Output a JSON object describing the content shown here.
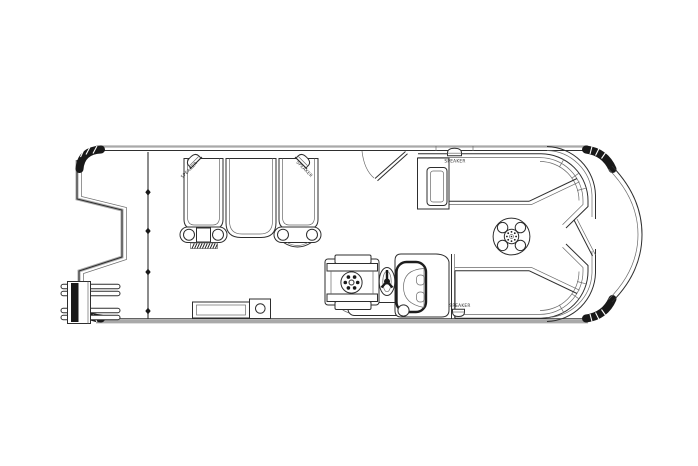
{
  "drawing": {
    "type": "pontoon-boat-floorplan-top-view",
    "colors": {
      "background": "#ffffff",
      "line": "#2e2e2e",
      "line_light": "#6a6a6a",
      "gray_edge": "#a9a9a9",
      "dark_cap": "#191919"
    },
    "labels": {
      "speakers": [
        {
          "id": "stern-port",
          "text": "SPEAKER",
          "orientation": "diagonal-left"
        },
        {
          "id": "stern-starboard",
          "text": "SPEAKER",
          "orientation": "diagonal-right"
        },
        {
          "id": "bow-top",
          "text": "SPEAKER",
          "orientation": "horizontal"
        },
        {
          "id": "bow-bottom",
          "text": "SPEAKER",
          "orientation": "horizontal"
        }
      ]
    }
  }
}
